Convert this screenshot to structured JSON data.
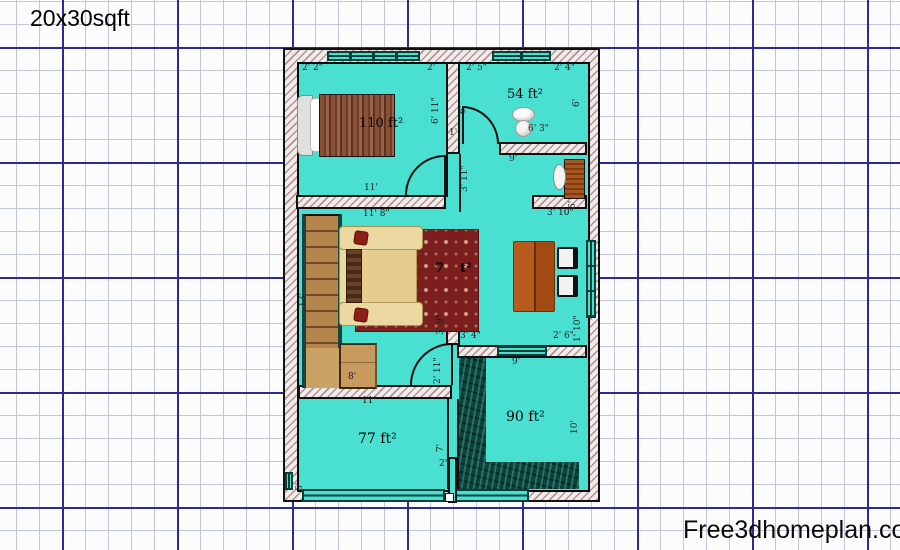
{
  "title": "20x30sqft",
  "watermark": "Free3dhomeplan.com",
  "colors": {
    "floor_teal": "#4ae0d1",
    "grid_major": "#2b2b96",
    "grid_minor": "#c2c6d9",
    "wall_hatch": "#bd8f8f",
    "water_floor": "#0a423c",
    "rug_red": "#7c1e1e",
    "wood": "#b6854e"
  },
  "plan": {
    "room_areas": [
      "110 ft²",
      "54 ft²",
      "77 ft²",
      "90 ft²",
      "7_ ft² (partially hidden by column)"
    ],
    "labels": [
      {
        "name": "dim-top-left",
        "text": "2' 2\"",
        "x": 17,
        "y": 14
      },
      {
        "name": "dim-top-bed-right",
        "text": "2'",
        "x": 142,
        "y": 14
      },
      {
        "name": "dim-top-bath-left",
        "text": "2' 5\"",
        "x": 181,
        "y": 14
      },
      {
        "name": "dim-top-bath-right",
        "text": "2' 4\"",
        "x": 269,
        "y": 14
      },
      {
        "name": "area-bathroom",
        "text": "54 ft²",
        "x": 222,
        "y": 38,
        "cls": "area"
      },
      {
        "name": "dim-toilet",
        "text": "6' 3\"",
        "x": 243,
        "y": 75
      },
      {
        "name": "dim-door-one-foot",
        "text": "1'",
        "x": 164,
        "y": 79
      },
      {
        "name": "dim-corridor",
        "text": "9'",
        "x": 224,
        "y": 105
      },
      {
        "name": "dim-sink-passage",
        "text": "3' 10\"",
        "x": 262,
        "y": 159
      },
      {
        "name": "dim-bedroom-width",
        "text": "11'",
        "x": 79,
        "y": 134
      },
      {
        "name": "area-bedroom",
        "text": "110 ft²",
        "x": 74,
        "y": 67,
        "cls": "area"
      },
      {
        "name": "dim-hall-width",
        "text": "11' 8\"",
        "x": 78,
        "y": 160
      },
      {
        "name": "dim-stairs",
        "text": "8'",
        "x": 63,
        "y": 323
      },
      {
        "name": "dim-room77-width",
        "text": "11'",
        "x": 77,
        "y": 347
      },
      {
        "name": "area-room77",
        "text": "77 ft²",
        "x": 73,
        "y": 382,
        "cls": "area-lg"
      },
      {
        "name": "dim-dining-left",
        "text": "3' 4\"",
        "x": 175,
        "y": 282
      },
      {
        "name": "dim-dining-right",
        "text": "2' 6\"",
        "x": 268,
        "y": 282
      },
      {
        "name": "dim-room90-width",
        "text": "9'",
        "x": 227,
        "y": 308
      },
      {
        "name": "area-room90",
        "text": "90 ft²",
        "x": 221,
        "y": 360,
        "cls": "area-lg"
      },
      {
        "name": "hall-area-prefix",
        "text": "7",
        "x": 150,
        "y": 212,
        "cls": "hall"
      },
      {
        "name": "hall-area-suffix",
        "text": "t²",
        "x": 175,
        "y": 212,
        "cls": "hall"
      },
      {
        "name": "dim-small-two",
        "text": "2'",
        "x": 154,
        "y": 410
      },
      {
        "name": "dim-bedroom-height",
        "text": "6' 11\"",
        "x": 147,
        "y": 74,
        "rot": true
      },
      {
        "name": "dim-bathroom-height",
        "text": "6'",
        "x": 288,
        "y": 57,
        "rot": true
      },
      {
        "name": "dim-bath-door",
        "text": "6'",
        "x": 174,
        "y": 64,
        "rot": true
      },
      {
        "name": "dim-passage-height",
        "text": "3' 11\"",
        "x": 176,
        "y": 142,
        "rot": true
      },
      {
        "name": "dim-sink-height",
        "text": "6'",
        "x": 284,
        "y": 159,
        "rot": true
      },
      {
        "name": "dim-stairs-height",
        "text": "13'",
        "x": 14,
        "y": 257,
        "rot": true
      },
      {
        "name": "dim-hall-right",
        "text": "3' 9\"",
        "x": 152,
        "y": 285,
        "rot": true
      },
      {
        "name": "dim-door77",
        "text": "2' 11\"",
        "x": 149,
        "y": 334,
        "rot": true
      },
      {
        "name": "dim-room77-height",
        "text": "7'",
        "x": 152,
        "y": 402,
        "rot": true
      },
      {
        "name": "dim-room90-height",
        "text": "10'",
        "x": 286,
        "y": 384,
        "rot": true
      },
      {
        "name": "dim-dining-corner",
        "text": "1' 10\"",
        "x": 289,
        "y": 292,
        "rot": true
      },
      {
        "name": "dim-bottom-left",
        "text": "6'",
        "x": 11,
        "y": 441,
        "rot": true
      }
    ]
  }
}
